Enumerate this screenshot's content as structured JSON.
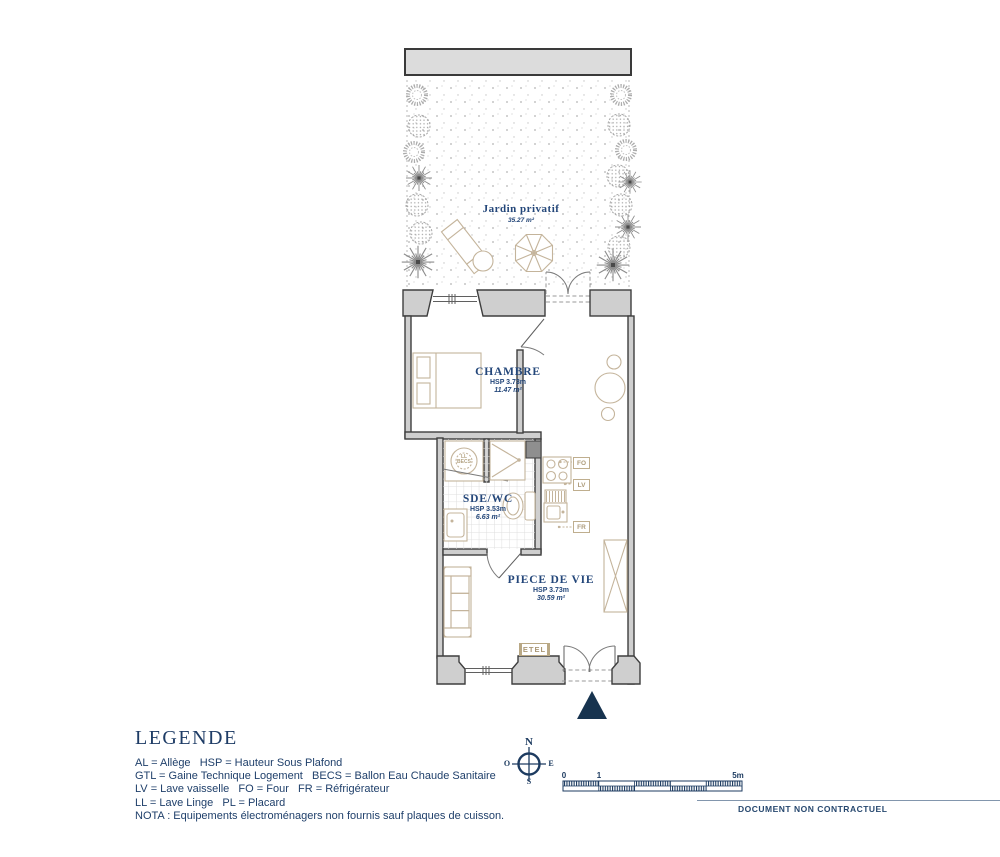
{
  "colors": {
    "navy_text": "#24477a",
    "navy_symbol": "#1d3b60",
    "wall_gray": "#cfcfcf",
    "furniture_beige": "#c4b49b"
  },
  "garden": {
    "name": "Jardin privatif",
    "area": "35.27 m²"
  },
  "rooms": {
    "chambre": {
      "name": "CHAMBRE",
      "hsp": "HSP 3.73m",
      "area": "11.47 m²"
    },
    "sdewc": {
      "name": "SDE/WC",
      "hsp": "HSP 3.53m",
      "area": "6.63 m²"
    },
    "piecedevie": {
      "name": "PIECE DE VIE",
      "hsp": "HSP 3.73m",
      "area": "30.59 m²"
    }
  },
  "fixtures": {
    "ll": "LL",
    "becs": "BECS",
    "fo": "FO",
    "lv": "LV",
    "fr": "FR",
    "etel": "ETEL"
  },
  "legend": {
    "title": "LEGENDE",
    "lines": [
      "AL = Allège   HSP = Hauteur Sous Plafond",
      "GTL = Gaine Technique Logement   BECS = Ballon Eau Chaude Sanitaire",
      "LV = Lave vaisselle   FO = Four   FR = Réfrigérateur",
      "LL = Lave Linge   PL = Placard",
      "NOTA : Equipements électroménagers non fournis sauf plaques de cuisson."
    ]
  },
  "compass": {
    "n": "N",
    "s": "S",
    "e": "E",
    "o": "O"
  },
  "scalebar": {
    "start": "0",
    "one": "1",
    "end": "5m"
  },
  "footer": {
    "disclaimer": "DOCUMENT NON CONTRACTUEL"
  }
}
